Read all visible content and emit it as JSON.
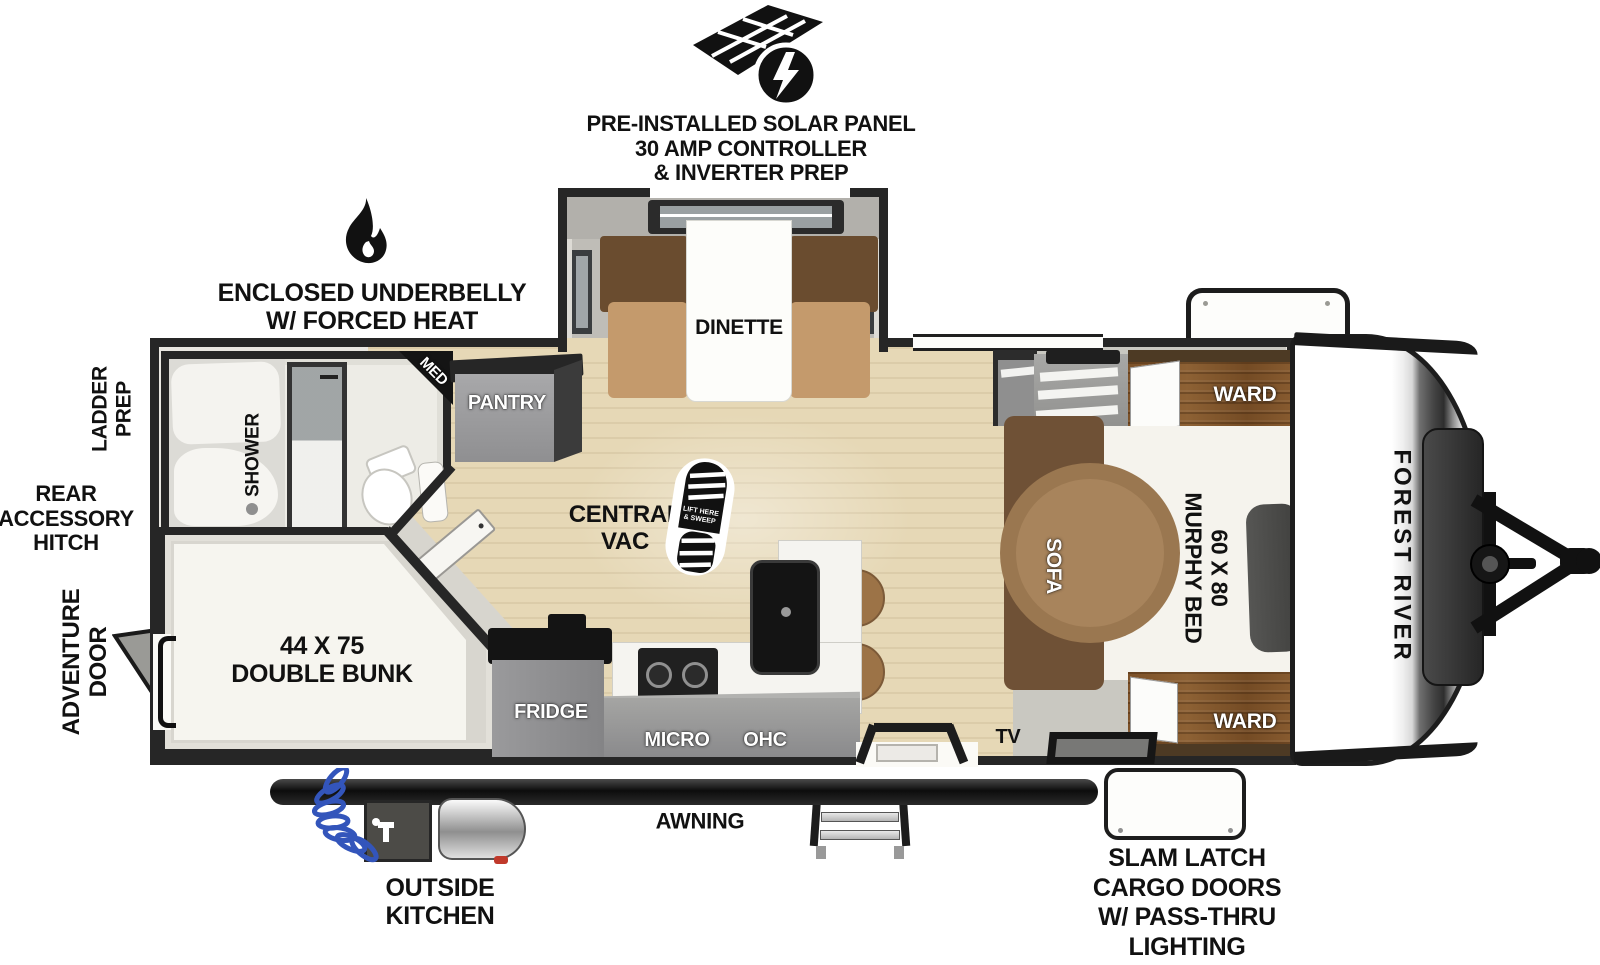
{
  "labels": {
    "solar": "PRE-INSTALLED SOLAR PANEL\n30 AMP CONTROLLER\n& INVERTER PREP",
    "underbelly": "ENCLOSED UNDERBELLY\nW/ FORCED HEAT",
    "ladder_prep": "LADDER\nPREP",
    "rear_hitch": "REAR\nACCESSORY\nHITCH",
    "adventure_door": "ADVENTURE\nDOOR",
    "awning": "AWNING",
    "outside_kitchen": "OUTSIDE\nKITCHEN",
    "cargo_doors": "SLAM LATCH\nCARGO DOORS\nW/ PASS-THRU\nLIGHTING"
  },
  "rooms": {
    "dinette": "DINETTE",
    "shower": "SHOWER",
    "med": "MED",
    "pantry": "PANTRY",
    "central_vac": "CENTRAL\nVAC",
    "vac_boot": "LIFT HERE\n& SWEEP",
    "double_bunk": "44 X 75\nDOUBLE BUNK",
    "fridge": "FRIDGE",
    "micro": "MICRO",
    "ohc": "OHC",
    "tv": "TV",
    "sofa": "SOFA",
    "murphy_bed": "60 X 80\nMURPHY BED",
    "ward_top": "WARD",
    "ward_bottom": "WARD",
    "brand": "FOREST RIVER"
  },
  "colors": {
    "wall_dark": "#262626",
    "floor_wood": "#e6d8b6",
    "furniture_wood": "#7c5128",
    "sofa_brown": "#9a7750",
    "cabinet_gray": "#8e8e8e",
    "hose_blue": "#3355bb"
  }
}
